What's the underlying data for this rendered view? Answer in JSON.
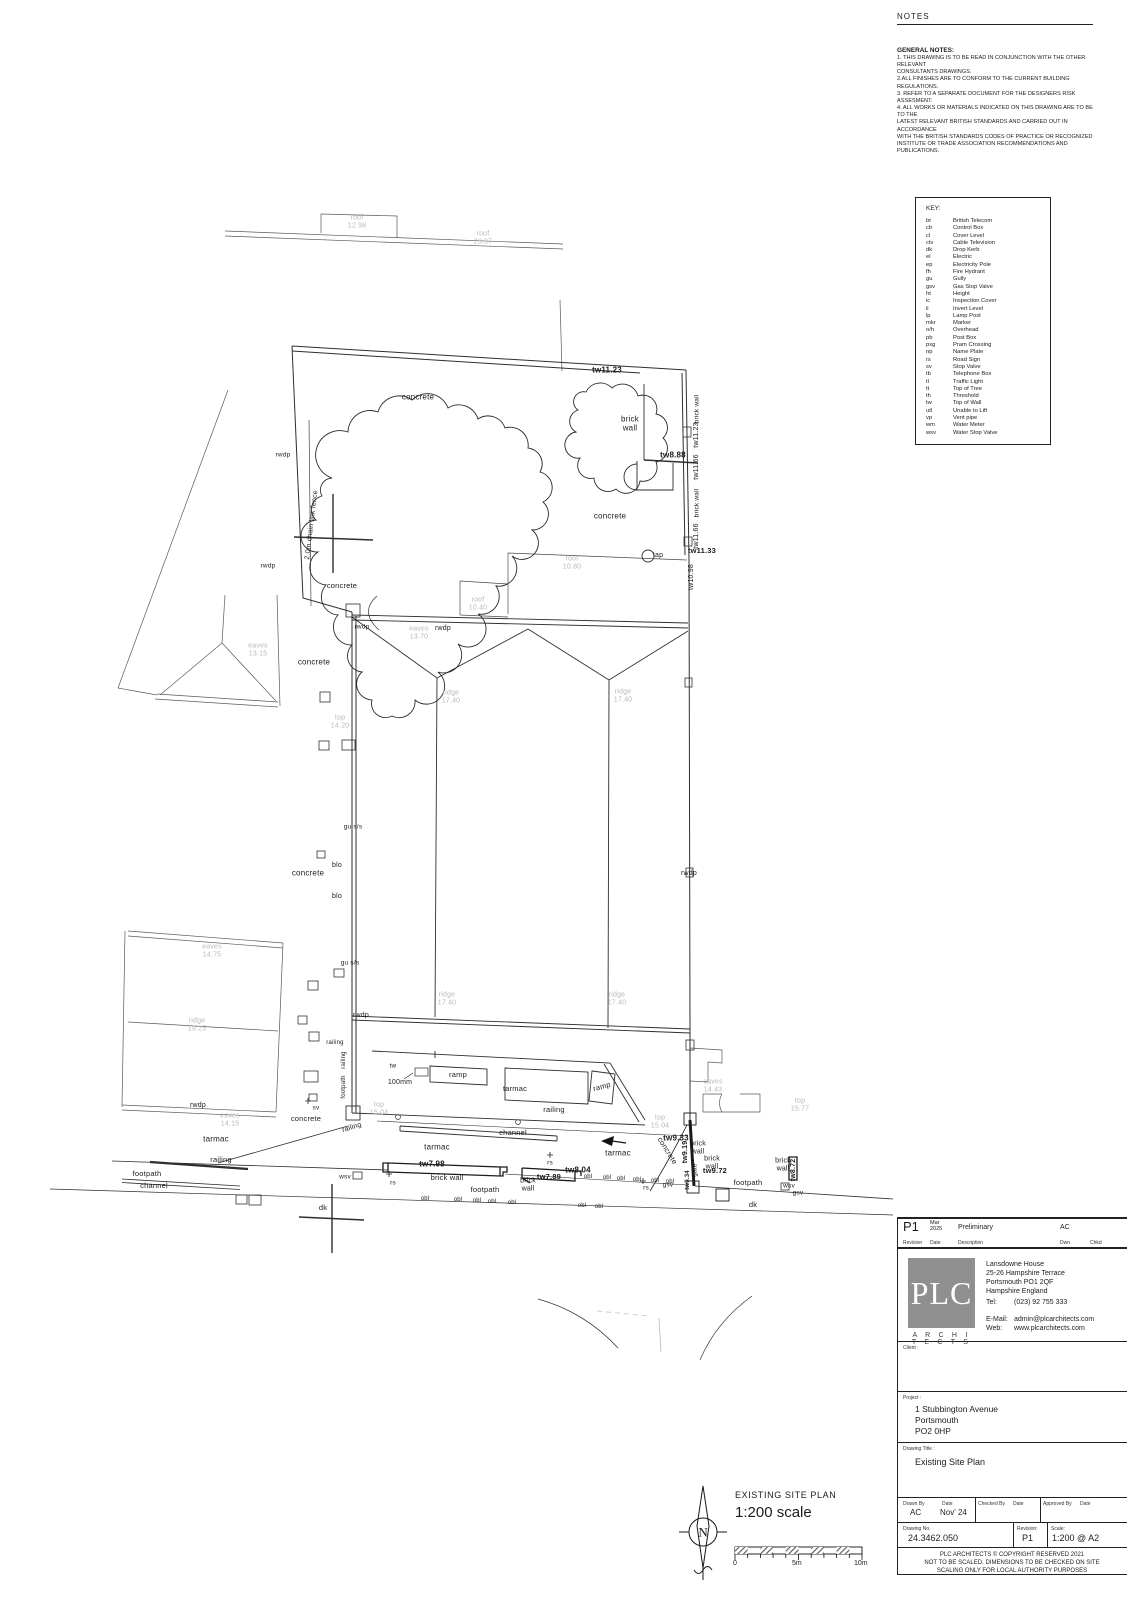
{
  "notes": {
    "title": "NOTES",
    "heading": "GENERAL NOTES:",
    "lines": [
      "1. THIS DRAWING IS TO BE READ IN CONJUNCTION WITH THE OTHER RELEVANT",
      "CONSULTANTS DRAWINGS.",
      "2.ALL FINISHES ARE  TO CONFORM TO THE CURRENT BUILDING REGULATIONS.",
      "3. REFER TO A SEPARATE DOCUMENT FOR THE DESIGNERS RISK ASSESMENT.",
      "4. ALL WORKS OR MATERIALS INDICATED ON THIS DRAWING ARE TO BE TO THE",
      "LATEST RELEVANT BRITISH STANDARDS AND CARRIED OUT IN ACCORDANCE",
      "WITH THE BRITISH STANDARDS CODES OF PRACTICE OR RECOGNIZED",
      "INSTITUTE OR TRADE ASSOCIATION RECOMMENDATIONS AND PUBLICATIONS."
    ]
  },
  "key": {
    "title": "KEY:",
    "items": [
      {
        "abbr": "bt",
        "term": "British Telecom"
      },
      {
        "abbr": "cb",
        "term": "Control Box"
      },
      {
        "abbr": "cl",
        "term": "Cover Level"
      },
      {
        "abbr": "ctv",
        "term": "Cable Television"
      },
      {
        "abbr": "dk",
        "term": "Drop Kerb"
      },
      {
        "abbr": "el",
        "term": "Electric"
      },
      {
        "abbr": "ep",
        "term": "Electricity Pole"
      },
      {
        "abbr": "fh",
        "term": "Fire Hydrant"
      },
      {
        "abbr": "gu",
        "term": "Gully"
      },
      {
        "abbr": "gsv",
        "term": "Gas Stop Valve"
      },
      {
        "abbr": "ht",
        "term": "Height"
      },
      {
        "abbr": "ic",
        "term": "Inspection Cover"
      },
      {
        "abbr": "il",
        "term": "Invert Level"
      },
      {
        "abbr": "lp",
        "term": "Lamp Post"
      },
      {
        "abbr": "mkr",
        "term": "Marker"
      },
      {
        "abbr": "o/h",
        "term": "Overhead"
      },
      {
        "abbr": "pb",
        "term": "Post Box"
      },
      {
        "abbr": "pxg",
        "term": "Pram Crossing"
      },
      {
        "abbr": "np",
        "term": "Name Plate"
      },
      {
        "abbr": "rs",
        "term": "Road Sign"
      },
      {
        "abbr": "sv",
        "term": "Stop Valve"
      },
      {
        "abbr": "tb",
        "term": "Telephone Box"
      },
      {
        "abbr": "tl",
        "term": "Traffic Light"
      },
      {
        "abbr": "tt",
        "term": "Top of Tree"
      },
      {
        "abbr": "th",
        "term": "Threshold"
      },
      {
        "abbr": "tw",
        "term": "Top of Wall"
      },
      {
        "abbr": "utl",
        "term": "Unable to Lift"
      },
      {
        "abbr": "vp",
        "term": "Vent pipe"
      },
      {
        "abbr": "wm",
        "term": "Water Meter"
      },
      {
        "abbr": "wsv",
        "term": "Water Stop Valve"
      }
    ]
  },
  "plan": {
    "labels": [
      {
        "t": "concrete",
        "x": 418,
        "y": 398
      },
      {
        "t": "concrete",
        "x": 610,
        "y": 517
      },
      {
        "t": "concrete",
        "x": 342,
        "y": 586,
        "fs": 7.5
      },
      {
        "t": "concrete",
        "x": 314,
        "y": 663
      },
      {
        "t": "concrete",
        "x": 308,
        "y": 874
      },
      {
        "t": "concrete",
        "x": 306,
        "y": 1119,
        "fs": 7.5
      },
      {
        "t": "concrete",
        "x": 667,
        "y": 1151,
        "r": 58,
        "fs": 7.5
      },
      {
        "t": "tarmac",
        "x": 216,
        "y": 1140
      },
      {
        "t": "tarmac",
        "x": 437,
        "y": 1148
      },
      {
        "t": "tarmac",
        "x": 618,
        "y": 1154
      },
      {
        "t": "tarmac",
        "x": 515,
        "y": 1089,
        "fs": 7.5
      },
      {
        "t": "footpath",
        "x": 147,
        "y": 1174,
        "fs": 7.5
      },
      {
        "t": "footpath",
        "x": 485,
        "y": 1190,
        "fs": 7.5
      },
      {
        "t": "footpath",
        "x": 748,
        "y": 1183,
        "fs": 7.5
      },
      {
        "t": "channel",
        "x": 154,
        "y": 1186,
        "fs": 7.5
      },
      {
        "t": "channel",
        "x": 513,
        "y": 1133,
        "fs": 7.5
      },
      {
        "t": "railing",
        "x": 221,
        "y": 1160,
        "fs": 7.5
      },
      {
        "t": "railing",
        "x": 554,
        "y": 1110,
        "fs": 7.5
      },
      {
        "t": "railing",
        "x": 335,
        "y": 1043,
        "fs": 6
      },
      {
        "t": "railing",
        "x": 344,
        "y": 1060,
        "r": -90,
        "fs": 6
      },
      {
        "t": "footpath",
        "x": 344,
        "y": 1087,
        "r": -90,
        "fs": 6
      },
      {
        "t": "railing",
        "x": 352,
        "y": 1128,
        "r": -18,
        "fs": 7
      },
      {
        "t": "dk",
        "x": 323,
        "y": 1208,
        "fs": 7.5
      },
      {
        "t": "dk",
        "x": 753,
        "y": 1205,
        "fs": 7.5
      },
      {
        "t": "rs",
        "x": 393,
        "y": 1183,
        "fs": 6.5
      },
      {
        "t": "rs",
        "x": 550,
        "y": 1163,
        "fs": 6.5
      },
      {
        "t": "rs",
        "x": 646,
        "y": 1188,
        "fs": 6.5
      },
      {
        "t": "wsv",
        "x": 345,
        "y": 1177,
        "fs": 6.5
      },
      {
        "t": "wsv",
        "x": 789,
        "y": 1186,
        "fs": 6.5
      },
      {
        "t": "gsv",
        "x": 798,
        "y": 1193,
        "fs": 6.5
      },
      {
        "t": "gsv",
        "x": 668,
        "y": 1185,
        "fs": 6.5
      },
      {
        "t": "sv",
        "x": 316,
        "y": 1108,
        "fs": 6.5
      },
      {
        "t": "gu s/s",
        "x": 353,
        "y": 827,
        "fs": 6.5
      },
      {
        "t": "gu s/s",
        "x": 350,
        "y": 963,
        "fs": 6.5
      },
      {
        "t": "blo",
        "x": 337,
        "y": 866,
        "fs": 7
      },
      {
        "t": "blo",
        "x": 337,
        "y": 897,
        "fs": 7
      },
      {
        "t": "tw",
        "x": 393,
        "y": 1066,
        "fs": 6.5
      },
      {
        "t": "100mm",
        "x": 400,
        "y": 1083,
        "fs": 7
      },
      {
        "t": "ramp",
        "x": 458,
        "y": 1075,
        "fs": 7.5
      },
      {
        "t": "ramp",
        "x": 602,
        "y": 1087,
        "r": -15,
        "fs": 7.5
      },
      {
        "t": "tap",
        "x": 658,
        "y": 556,
        "fs": 7
      },
      {
        "t": "gate",
        "x": 695,
        "y": 1170,
        "r": -90,
        "fs": 6.5
      },
      {
        "t": "2.0m chain link fence",
        "x": 312,
        "y": 525,
        "r": -83,
        "fs": 7
      },
      {
        "t": "rwdp",
        "x": 283,
        "y": 455,
        "fs": 6.5
      },
      {
        "t": "rwdp",
        "x": 268,
        "y": 566,
        "fs": 6.5
      },
      {
        "t": "rwdp",
        "x": 362,
        "y": 627,
        "fs": 6.5
      },
      {
        "t": "rwdp",
        "x": 443,
        "y": 629,
        "fs": 7
      },
      {
        "t": "rwdp",
        "x": 361,
        "y": 1016,
        "fs": 7
      },
      {
        "t": "rwdp",
        "x": 689,
        "y": 874,
        "fs": 7
      },
      {
        "t": "rwdp",
        "x": 198,
        "y": 1106,
        "fs": 7
      },
      {
        "t": "brick\nwall",
        "x": 630,
        "y": 424
      },
      {
        "t": "brick\nwall",
        "x": 698,
        "y": 1148,
        "fs": 7
      },
      {
        "t": "brick\nwall",
        "x": 712,
        "y": 1163,
        "fs": 7
      },
      {
        "t": "brick\nwall",
        "x": 783,
        "y": 1165,
        "fs": 7
      },
      {
        "t": "brick wall",
        "x": 447,
        "y": 1178,
        "fs": 7.5
      },
      {
        "t": "brick\nwall",
        "x": 528,
        "y": 1185,
        "fs": 7
      },
      {
        "t": "tw11.23",
        "x": 607,
        "y": 371,
        "c": "b"
      },
      {
        "t": "tw8.88",
        "x": 673,
        "y": 456,
        "c": "b"
      },
      {
        "t": "tw11.33",
        "x": 702,
        "y": 551,
        "c": "b",
        "fs": 7.5
      },
      {
        "t": "tw9.33",
        "x": 676,
        "y": 1139,
        "c": "b"
      },
      {
        "t": "tw7.98",
        "x": 432,
        "y": 1165,
        "c": "b"
      },
      {
        "t": "tw8.04",
        "x": 578,
        "y": 1171,
        "c": "b"
      },
      {
        "t": "tw7.89",
        "x": 549,
        "y": 1177,
        "c": "b",
        "fs": 7.5
      },
      {
        "t": "tw9.72",
        "x": 715,
        "y": 1171,
        "c": "b",
        "fs": 7.5
      },
      {
        "t": "tw8.72",
        "x": 794,
        "y": 1170,
        "c": "b",
        "r": -90,
        "fs": 7
      },
      {
        "t": "tw9.19",
        "x": 686,
        "y": 1152,
        "c": "b",
        "r": -90,
        "fs": 7
      },
      {
        "t": "tw9.34",
        "x": 688,
        "y": 1180,
        "c": "b",
        "r": -90,
        "fs": 6
      },
      {
        "t": "brick wall",
        "x": 697,
        "y": 409,
        "r": -90,
        "fs": 6.5
      },
      {
        "t": "tw11.23",
        "x": 697,
        "y": 435,
        "r": -90,
        "fs": 7
      },
      {
        "t": "tw11.66",
        "x": 697,
        "y": 467,
        "r": -90,
        "fs": 7
      },
      {
        "t": "brick wall",
        "x": 697,
        "y": 503,
        "r": -90,
        "fs": 6.5
      },
      {
        "t": "tw11.66",
        "x": 697,
        "y": 536,
        "r": -90,
        "fs": 7
      },
      {
        "t": "tw10.98",
        "x": 692,
        "y": 577,
        "r": -90,
        "fs": 7
      },
      {
        "t": "obl",
        "x": 588,
        "y": 1177,
        "fs": 6
      },
      {
        "t": "obl",
        "x": 607,
        "y": 1178,
        "fs": 6
      },
      {
        "t": "obl",
        "x": 621,
        "y": 1179,
        "fs": 6
      },
      {
        "t": "obl",
        "x": 637,
        "y": 1180,
        "fs": 6
      },
      {
        "t": "obl",
        "x": 655,
        "y": 1181,
        "fs": 6
      },
      {
        "t": "obl",
        "x": 670,
        "y": 1182,
        "fs": 6
      },
      {
        "t": "obl",
        "x": 425,
        "y": 1199,
        "fs": 6
      },
      {
        "t": "obl",
        "x": 458,
        "y": 1200,
        "fs": 6
      },
      {
        "t": "obl",
        "x": 477,
        "y": 1201,
        "fs": 6
      },
      {
        "t": "obl",
        "x": 492,
        "y": 1202,
        "fs": 6
      },
      {
        "t": "obl",
        "x": 512,
        "y": 1203,
        "fs": 6
      },
      {
        "t": "obl",
        "x": 582,
        "y": 1206,
        "fs": 6
      },
      {
        "t": "obl",
        "x": 599,
        "y": 1207,
        "fs": 6
      },
      {
        "t": "roof\n12.98",
        "x": 357,
        "y": 222,
        "c": "g",
        "fs": 7
      },
      {
        "t": "roof\n23.97",
        "x": 483,
        "y": 238,
        "c": "g",
        "fs": 7
      },
      {
        "t": "eaves\n13.15",
        "x": 258,
        "y": 650,
        "c": "g",
        "fs": 7
      },
      {
        "t": "roof\n10.40",
        "x": 478,
        "y": 604,
        "c": "g",
        "fs": 7
      },
      {
        "t": "roof\n10.80",
        "x": 572,
        "y": 563,
        "c": "g",
        "fs": 7
      },
      {
        "t": "eaves\n13.70",
        "x": 419,
        "y": 633,
        "c": "g",
        "fs": 7
      },
      {
        "t": "ridge\n17.40",
        "x": 451,
        "y": 697,
        "c": "g",
        "fs": 7
      },
      {
        "t": "ridge\n17.40",
        "x": 623,
        "y": 696,
        "c": "g",
        "fs": 7
      },
      {
        "t": "ridge\n17.40",
        "x": 447,
        "y": 999,
        "c": "g",
        "fs": 7
      },
      {
        "t": "ridge\n17.40",
        "x": 617,
        "y": 999,
        "c": "g",
        "fs": 7
      },
      {
        "t": "top\n14.20",
        "x": 340,
        "y": 722,
        "c": "g",
        "fs": 7
      },
      {
        "t": "eaves\n14.75",
        "x": 212,
        "y": 951,
        "c": "g",
        "fs": 7
      },
      {
        "t": "ridge\n19.25",
        "x": 197,
        "y": 1025,
        "c": "g",
        "fs": 7
      },
      {
        "t": "eaves\n14.15",
        "x": 230,
        "y": 1120,
        "c": "g",
        "fs": 7
      },
      {
        "t": "top\n15.04",
        "x": 379,
        "y": 1109,
        "c": "g",
        "fs": 7
      },
      {
        "t": "top\n15.04",
        "x": 660,
        "y": 1122,
        "c": "g",
        "fs": 7
      },
      {
        "t": "eaves\n14.43",
        "x": 713,
        "y": 1086,
        "c": "g",
        "fs": 7
      },
      {
        "t": "top\n15.77",
        "x": 800,
        "y": 1105,
        "c": "g",
        "fs": 7
      }
    ]
  },
  "scalebar": {
    "title": "EXISTING SITE PLAN",
    "scale_text": "1:200 scale",
    "zero": "0",
    "mid": "5m",
    "end": "10m",
    "north": "N"
  },
  "titleblock": {
    "rev_row": {
      "rev": "P1",
      "date": "Mar\n2025",
      "desc": "Preliminary",
      "dwn": "AC"
    },
    "rev_headers": {
      "revision": "Revision",
      "date": "Date",
      "description": "Description",
      "dwn": "Dwn",
      "chkd": "Chkd"
    },
    "logo": {
      "text": "PLC",
      "sub": "A R C H I T E C T S"
    },
    "address": [
      "Lansdowne House",
      "25-26 Hampshire Terrace",
      "Portsmouth PO1 2QF",
      "Hampshire England"
    ],
    "tel_label": "Tel:",
    "tel": "(023) 92 755 333",
    "email_label": "E-Mail:",
    "email": "admin@plcarchitects.com",
    "web_label": "Web:",
    "web": "www.plcarchitects.com",
    "client_label": "Client :",
    "project_label": "Project :",
    "project": [
      "1 Stubbington Avenue",
      "Portsmouth",
      "PO2 0HP"
    ],
    "drawing_title_label": "Drawing Title :",
    "drawing_title": "Existing Site Plan",
    "drawn_by_label": "Drawn By",
    "drawn_by": "AC",
    "date_label": "Date",
    "date": "Nov' 24",
    "checked_by_label": "Checked By",
    "approved_by_label": "Approved By",
    "drawing_no_label": "Drawing No.",
    "drawing_no": "24.3462.050",
    "revision_label": "Revision:",
    "revision": "P1",
    "scale_label": "Scale:",
    "scale": "1:200 @ A2",
    "footer": [
      "PLC ARCHITECTS      ©      COPYRIGHT RESERVED  2021",
      "NOT TO BE SCALED.  DIMENSIONS TO BE CHECKED ON SITE",
      "SCALING ONLY FOR LOCAL AUTHORITY PURPOSES"
    ]
  }
}
